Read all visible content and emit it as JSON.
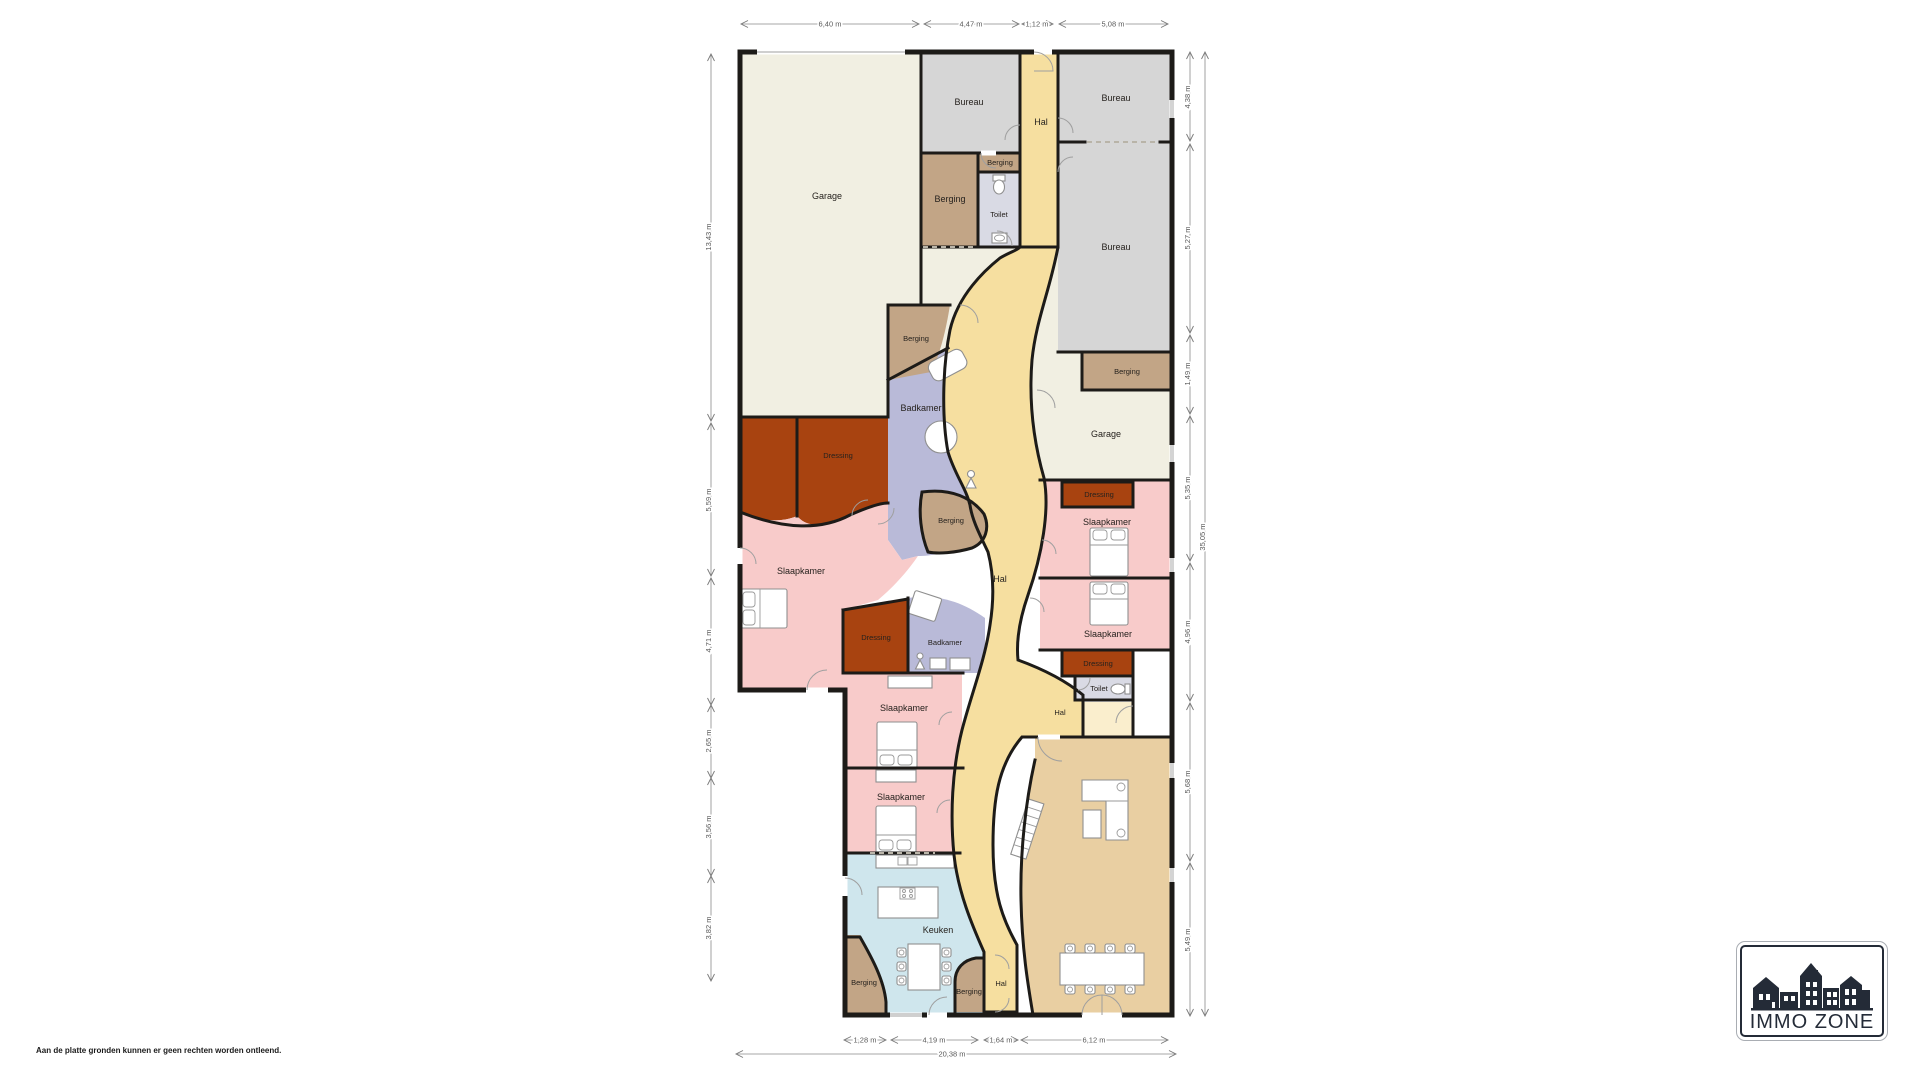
{
  "disclaimer": {
    "text": "Aan de platte gronden kunnen er geen rechten worden ontleend."
  },
  "logo": {
    "title": "IMMO ZONE"
  },
  "colors": {
    "wall": "#1d1b18",
    "cream": "#f1efe2",
    "bureau_gray": "#d6d6d6",
    "hal_yellow": "#f6dfa0",
    "hal_pale": "#faeecd",
    "berging_tan": "#c2a586",
    "badkamer_lavender": "#b9bad8",
    "slaapkamer_pink": "#f8cbca",
    "dressing_brick": "#a84310",
    "keuken_blue": "#cfe6ed",
    "living_wheat": "#e9cfa2",
    "toilet_gray": "#d9dae4",
    "white": "#ffffff"
  },
  "rooms": [
    "Garage",
    "Bureau",
    "Hal",
    "Bureau",
    "Berging",
    "Berging",
    "Toilet",
    "Bureau",
    "Berging",
    "Badkamer",
    "Dressing",
    "Garage",
    "Berging",
    "Dressing",
    "Slaapkamer",
    "Slaapkamer",
    "Berging",
    "Hal",
    "Dressing",
    "Badkamer",
    "Slaapkamer",
    "Dressing",
    "Toilet",
    "Hal",
    "Slaapkamer",
    "Slaapkamer",
    "Keuken",
    "Berging",
    "Berging",
    "Hal"
  ],
  "dims": {
    "top": [
      "6,40 m",
      "4,47 m",
      "1,12 m",
      "5,08 m"
    ],
    "bottom": [
      "1,28 m",
      "4,19 m",
      "1,64 m",
      "6,12 m"
    ],
    "bottom_total": "20,38 m",
    "left": [
      "13,43 m",
      "5,59 m",
      "4,71 m",
      "2,65 m",
      "3,56 m",
      "3,82 m"
    ],
    "right": [
      "4,38 m",
      "5,27 m",
      "1,49 m",
      "5,35 m",
      "4,96 m",
      "5,68 m",
      "5,49 m"
    ],
    "right_total": "35,05 m"
  }
}
